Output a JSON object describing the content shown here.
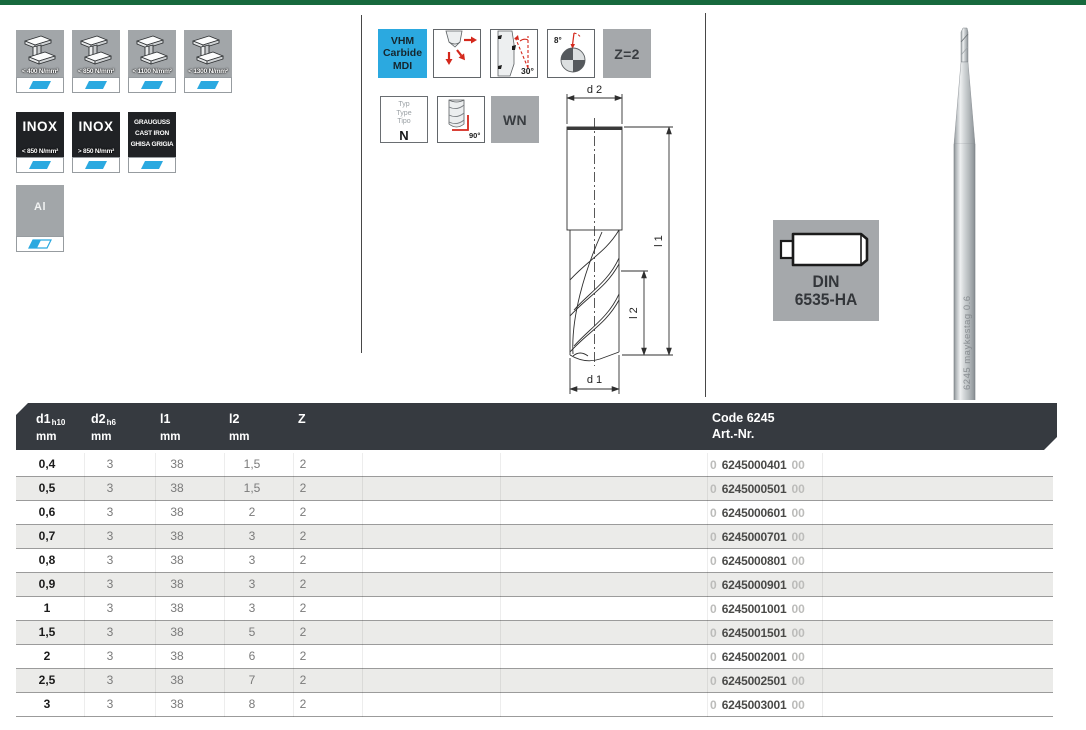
{
  "colors": {
    "top_bar": "#17693D",
    "accent_cyan": "#2BA9E0",
    "table_header": "#363A40",
    "pictogram_red": "#D42B1E",
    "badge_gray": "#A5A8AB"
  },
  "materials": {
    "steel": [
      {
        "label": "< 400 N/mm²"
      },
      {
        "label": "< 850 N/mm²"
      },
      {
        "label": "< 1100 N/mm²"
      },
      {
        "label": "< 1300 N/mm²"
      }
    ],
    "inox": [
      {
        "title": "INOX",
        "label": "< 850 N/mm²"
      },
      {
        "title": "INOX",
        "label": "> 850 N/mm²"
      }
    ],
    "cast_iron": {
      "lines": [
        "GRAUGUSS",
        "CAST IRON",
        "GHISA GRIGIA"
      ]
    },
    "aluminium": {
      "label": "Al"
    }
  },
  "features": {
    "vhm": {
      "lines": [
        "VHM",
        "Carbide",
        "MDI"
      ]
    },
    "helix_angle": "30°",
    "point_angle": "8°",
    "flutes": "Z=2",
    "typ": {
      "labels": [
        "Typ",
        "Type",
        "Tipo"
      ],
      "value": "N"
    },
    "corner_angle": "90°",
    "wn": "WN"
  },
  "drawing": {
    "d2": "d 2",
    "l1": "l 1",
    "l2": "l 2",
    "d1": "d 1"
  },
  "din": {
    "line1": "DIN",
    "line2": "6535-HA"
  },
  "tool_marking": "6245 maykestag 0.6",
  "table": {
    "headers": {
      "d1": {
        "main": "d1",
        "sub": "h10",
        "unit": "mm"
      },
      "d2": {
        "main": "d2",
        "sub": "h6",
        "unit": "mm"
      },
      "l1": {
        "main": "l1",
        "unit": "mm"
      },
      "l2": {
        "main": "l2",
        "unit": "mm"
      },
      "z": {
        "main": "Z"
      },
      "code": {
        "line1": "Code 6245",
        "line2": "Art.-Nr."
      }
    },
    "rows": [
      {
        "d1": "0,4",
        "d2": "3",
        "l1": "38",
        "l2": "1,5",
        "z": "2",
        "art_prefix": "0",
        "art_code": "6245000401",
        "art_suffix": "00"
      },
      {
        "d1": "0,5",
        "d2": "3",
        "l1": "38",
        "l2": "1,5",
        "z": "2",
        "art_prefix": "0",
        "art_code": "6245000501",
        "art_suffix": "00"
      },
      {
        "d1": "0,6",
        "d2": "3",
        "l1": "38",
        "l2": "2",
        "z": "2",
        "art_prefix": "0",
        "art_code": "6245000601",
        "art_suffix": "00"
      },
      {
        "d1": "0,7",
        "d2": "3",
        "l1": "38",
        "l2": "3",
        "z": "2",
        "art_prefix": "0",
        "art_code": "6245000701",
        "art_suffix": "00"
      },
      {
        "d1": "0,8",
        "d2": "3",
        "l1": "38",
        "l2": "3",
        "z": "2",
        "art_prefix": "0",
        "art_code": "6245000801",
        "art_suffix": "00"
      },
      {
        "d1": "0,9",
        "d2": "3",
        "l1": "38",
        "l2": "3",
        "z": "2",
        "art_prefix": "0",
        "art_code": "6245000901",
        "art_suffix": "00"
      },
      {
        "d1": "1",
        "d2": "3",
        "l1": "38",
        "l2": "3",
        "z": "2",
        "art_prefix": "0",
        "art_code": "6245001001",
        "art_suffix": "00"
      },
      {
        "d1": "1,5",
        "d2": "3",
        "l1": "38",
        "l2": "5",
        "z": "2",
        "art_prefix": "0",
        "art_code": "6245001501",
        "art_suffix": "00"
      },
      {
        "d1": "2",
        "d2": "3",
        "l1": "38",
        "l2": "6",
        "z": "2",
        "art_prefix": "0",
        "art_code": "6245002001",
        "art_suffix": "00"
      },
      {
        "d1": "2,5",
        "d2": "3",
        "l1": "38",
        "l2": "7",
        "z": "2",
        "art_prefix": "0",
        "art_code": "6245002501",
        "art_suffix": "00"
      },
      {
        "d1": "3",
        "d2": "3",
        "l1": "38",
        "l2": "8",
        "z": "2",
        "art_prefix": "0",
        "art_code": "6245003001",
        "art_suffix": "00"
      }
    ]
  }
}
